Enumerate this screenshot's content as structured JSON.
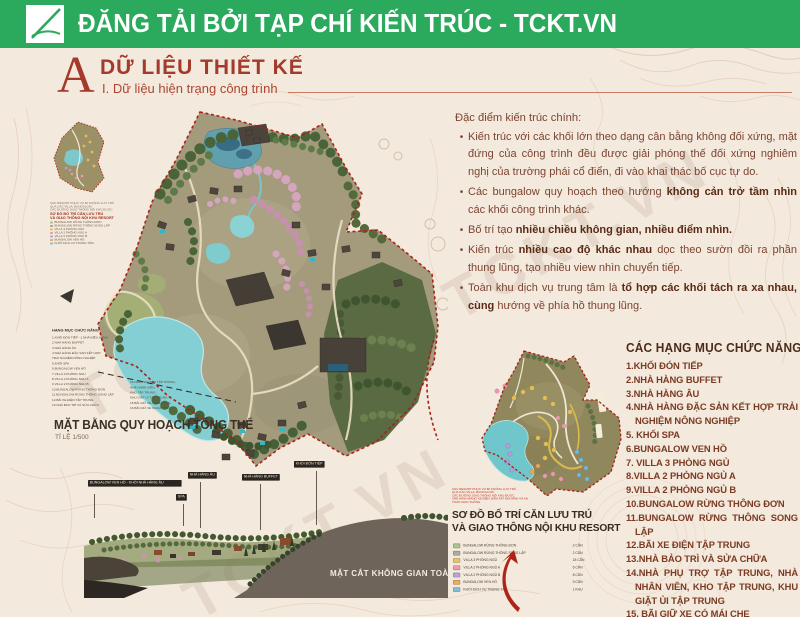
{
  "header": {
    "title": "ĐĂNG TẢI BỞI TẠP CHÍ KIẾN TRÚC - TCKT.VN",
    "brand_green": "#2ba95c"
  },
  "section": {
    "drop_cap": "A",
    "title": "DỮ LIỆU THIẾT KẾ",
    "subtitle": "I. Dữ liệu hiện trạng công trình"
  },
  "architecture_notes": {
    "heading": "Đặc điểm kiến trúc chính:",
    "bullets": [
      {
        "pre": "Kiến trúc với các khối lớn theo dạng cân bằng không đối xứng, mặt đứng của công trình đều được giải phóng thế đối xứng nghiêm nghị của trường phái cổ điển, đi vào khai thác bố cục tự do.",
        "bold": "",
        "post": ""
      },
      {
        "pre": "Các bungalow quy hoạch theo hướng ",
        "bold": "không cản trở tầm nhìn",
        "post": " các khối công trình khác."
      },
      {
        "pre": "Bố trí tạo ",
        "bold": "nhiều chiều không gian, nhiều điểm nhìn.",
        "post": ""
      },
      {
        "pre": "Kiến trúc ",
        "bold": "nhiều cao độ khác nhau",
        "post": " dọc theo sườn đồi ra phần thung lũng, tạo nhiều view nhìn chuyển tiếp."
      },
      {
        "pre": "Toàn khu dịch vụ trung tâm là ",
        "bold": "tổ hợp các khối tách ra xa nhau, cùng",
        "post": " hướng về phía hồ thung lũng."
      }
    ]
  },
  "master_plan": {
    "title": "MẶT BẰNG QUY HOẠCH TỔNG THỂ",
    "scale": "TỈ LỆ 1/500",
    "legend_title": "HẠNG MỤC CHỨC NĂNG",
    "legend_col1": [
      "1.KHỐI ĐÓN TIẾP - 1.NHÀ ĐIỀU HÀNH",
      "2.NHÀ HÀNG BUFFET",
      "3.NHÀ HÀNG ÂU",
      "4.NHÀ HÀNG ĐẶC SẢN KẾT HỢP",
      "  TRẢI NGHIỆM NÔNG NGHIỆP",
      "5.KHỐI SPA",
      "6.BUNGALOW VEN HỒ",
      "7.VILLA 3 PHÒNG NGỦ",
      "8.VILLA 2 PHÒNG NGỦ A",
      "9.VILLA 2 PHÒNG NGỦ B",
      "10.BUNGALOW RỪNG THÔNG ĐƠN",
      "11.BUNGALOW RỪNG THÔNG SONG LẬP",
      "12.BÃI XE ĐIỆN TẬP TRUNG",
      "13.NHÀ BẢO TRÌ VÀ SỬA CHỮA"
    ],
    "legend_col2": [
      "14.NHÀ PHỤ TRỢ TẬP TRUNG,",
      "  NHÀ NHÂN VIÊN,",
      "  KHO TẬP TRUNG,",
      "  KHU GIẶT ỦI TẬP TRUNG",
      "15.BÃI GIỮ XE CÓ MÁI CHE",
      "16.BÃI GIỮ XE NGOÀI TRỜI"
    ]
  },
  "section_view": {
    "title": "MẶT CẮT KHÔNG GIAN TOÀN KHU",
    "callouts": [
      "BUNGALOW VEN HỒ - KHỐI NHÀ HÀNG ÂU",
      "NHÀ HÀNG ÂU",
      "SPA",
      "NHÀ HÀNG BUFFET",
      "KHỐI ĐÓN TIẾP"
    ]
  },
  "unit_plan": {
    "label1": "SƠ ĐỒ BỐ TRÍ CĂN LƯU TRÚ",
    "label2": "VÀ GIAO THÔNG NỘI KHU RESORT",
    "caption": [
      "KHU RESORT PHỤC VỤ 80 PHÒNG LƯU TRÚ",
      "QUA CÁC VILLA, BUNGALOW.",
      "CÁC ĐƯỜNG GIAO THÔNG NỘI KHU ĐƯỢC",
      "VẬN HÀNH BẰNG XE ĐIỆN, BÁM SÁT ĐỊA HÌNH VÀ AN",
      "TOÀN GIAO THÔNG."
    ],
    "legend": [
      {
        "c": "#a9c68f",
        "t": "BUNGALOW RỪNG THÔNG ĐƠN",
        "n": "2 CĂN"
      },
      {
        "c": "#a7aaa5",
        "t": "BUNGALOW RỪNG THÔNG SONG LẬP",
        "n": "2 CĂN"
      },
      {
        "c": "#e5c45c",
        "t": "VILLA 3 PHÒNG NGỦ",
        "n": "18 CĂN"
      },
      {
        "c": "#eb9fb0",
        "t": "VILLA 2 PHÒNG NGỦ A",
        "n": "6 CĂN"
      },
      {
        "c": "#bba4da",
        "t": "VILLA 2 PHÒNG NGỦ B",
        "n": "8 CĂN"
      },
      {
        "c": "#ecaa62",
        "t": "BUNGALOW VEN HỒ",
        "n": "9 CĂN"
      },
      {
        "c": "#84bede",
        "t": "KHỐI DỊCH VỤ TRUNG TÂM",
        "n": "1 KHU"
      }
    ]
  },
  "program_list": {
    "heading": "CÁC HẠNG MỤC CHỨC NĂNG",
    "items": [
      {
        "n": "1.",
        "t": "KHỐI ĐÓN TIẾP"
      },
      {
        "n": "2.",
        "t": "NHÀ HÀNG BUFFET"
      },
      {
        "n": "3.",
        "t": "NHÀ HÀNG ÂU"
      },
      {
        "n": "4.",
        "t": "NHÀ HÀNG ĐẶC SẢN KẾT HỢP TRẢI NGHIỆM NÔNG NGHIỆP"
      },
      {
        "n": "5. ",
        "t": "KHỐI SPA"
      },
      {
        "n": "6.",
        "t": "BUNGALOW VEN HỒ"
      },
      {
        "n": "7. ",
        "t": "VILLA 3 PHÒNG NGỦ"
      },
      {
        "n": "8.",
        "t": "VILLA 2 PHÒNG NGỦ A"
      },
      {
        "n": "9.",
        "t": "VILLA 2 PHÒNG NGỦ B"
      },
      {
        "n": "10.",
        "t": "BUNGALOW RỪNG THÔNG ĐƠN"
      },
      {
        "n": "11.",
        "t": "BUNGALOW RỪNG THÔNG SONG LẬP"
      },
      {
        "n": "12.",
        "t": "BÃI XE ĐIỆN TẬP TRUNG"
      },
      {
        "n": "13.",
        "t": "NHÀ BẢO TRÌ VÀ SỬA CHỮA"
      },
      {
        "n": "14.",
        "t": "NHÀ PHỤ TRỢ TẬP TRUNG, NHÀ NHÂN VIÊN, KHO TẬP TRUNG, KHU GIẶT ỦI TẬP TRUNG"
      },
      {
        "n": "15. ",
        "t": "BÃI GIỮ XE CÓ MÁI CHE"
      },
      {
        "n": "16.",
        "t": "BÃI GIỮ XE NGOÀI TRỜI"
      }
    ]
  },
  "watermark": "TCKT.VN",
  "colors": {
    "brand_green": "#2ba95c",
    "title_red": "#a43a2b",
    "body_maroon": "#7c4431",
    "boundary_red": "#a8221a",
    "lake_turquoise": "#83cfd3",
    "terrain_olive": "#a49b7d",
    "paper": "#f3e9dc"
  }
}
